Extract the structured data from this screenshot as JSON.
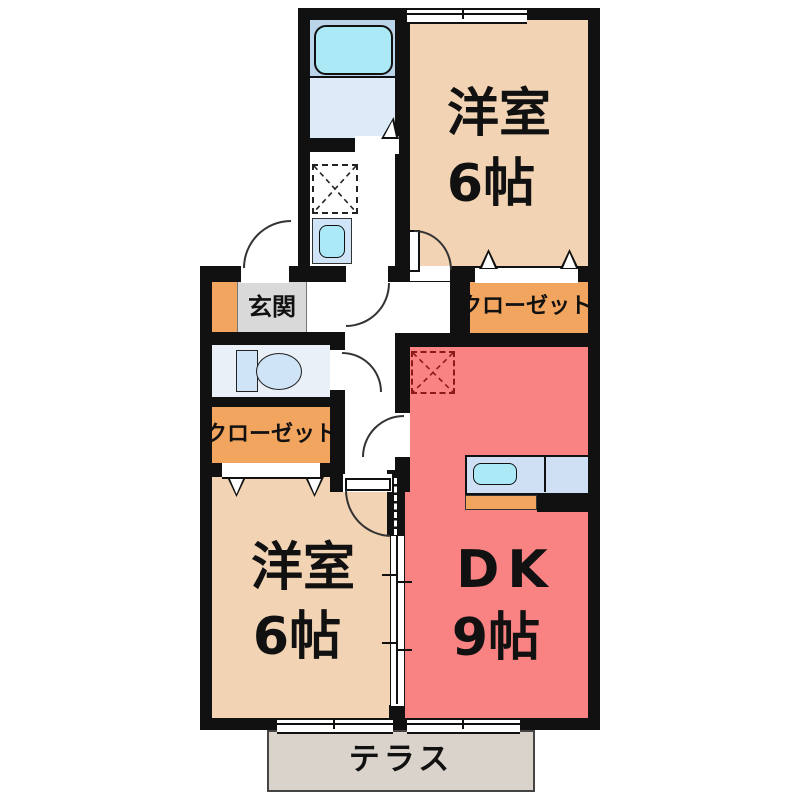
{
  "rooms": {
    "bedroom_top": {
      "name": "洋室",
      "size": "6帖"
    },
    "bedroom_bottom": {
      "name": "洋室",
      "size": "6帖"
    },
    "dining_kitchen": {
      "name": "DK",
      "size": "9帖"
    },
    "closet_top": {
      "name": "クローゼット"
    },
    "closet_bottom": {
      "name": "クローゼット"
    },
    "entrance": {
      "name": "玄関"
    },
    "terrace": {
      "name": "テラス"
    }
  },
  "fixtures": {
    "bathtub": "bathtub",
    "washbasin": "washbasin-sink",
    "laundry_space": "washing-machine-space-x-box",
    "toilet": "toilet-with-tank",
    "refrigerator_space": "refrigerator-space-x-box",
    "kitchen_counter": "kitchen-counter-with-sink"
  },
  "colors": {
    "wall": "#111111",
    "bedroom_fill": "#f2d3b3",
    "dk_fill": "#f98282",
    "closet_fill": "#f2a55e",
    "entrance_mat": "#d9d9d9",
    "terrace_fill": "#d9d3cb",
    "bath_fill": "#bad4ea",
    "washroom_fill": "#dcebf7",
    "toilet_room_fill": "#eaf0f8",
    "fixture_blue": "#cfe4f7",
    "tub_cyan": "#ace9f6",
    "refrigerator_dash": "#8b1a1a"
  }
}
